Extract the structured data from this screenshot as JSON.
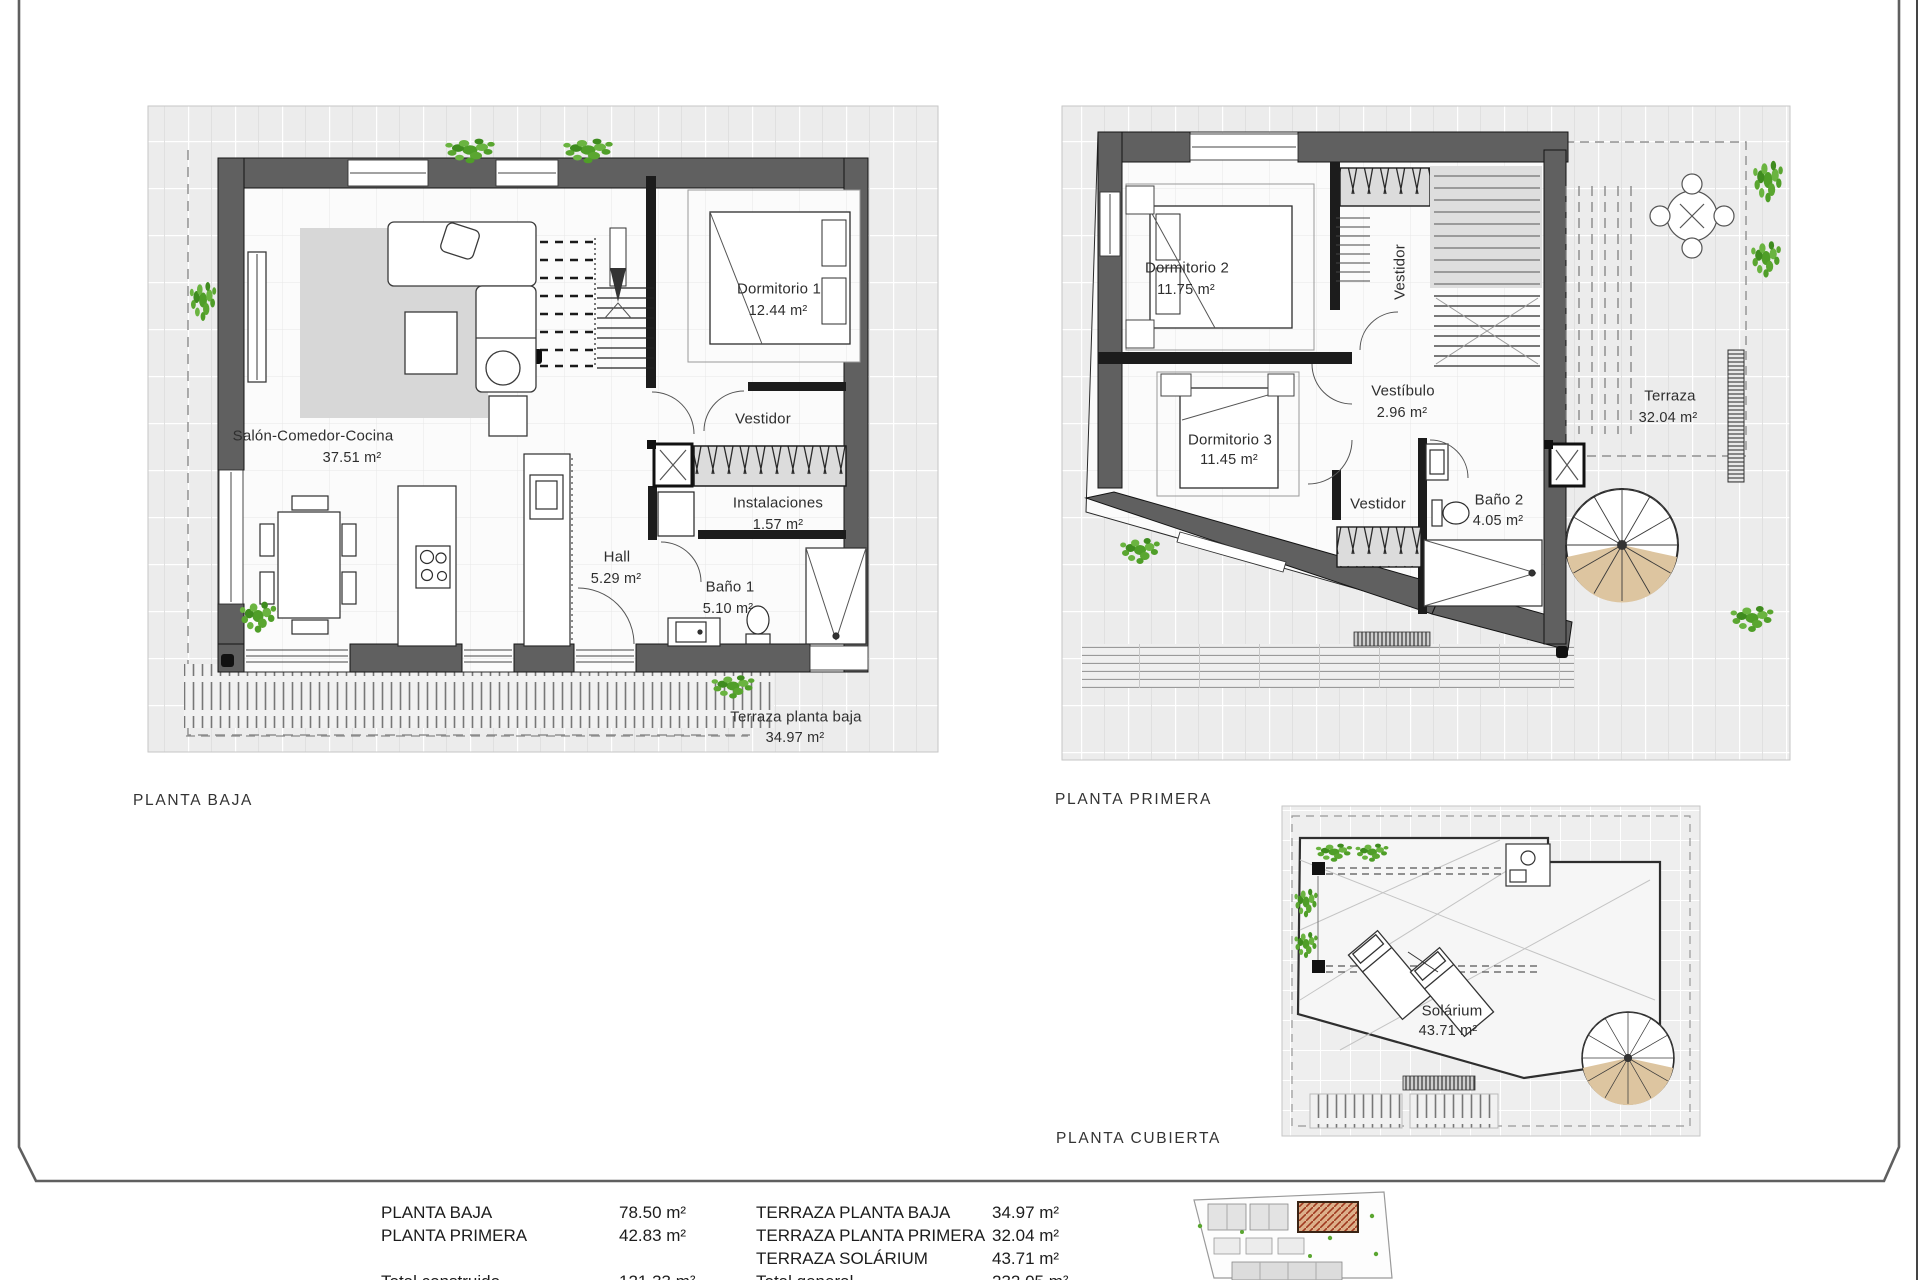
{
  "ground_floor": {
    "title": "PLANTA BAJA",
    "rooms": {
      "salon": {
        "name": "Salón-Comedor-Cocina",
        "area": "37.51 m²"
      },
      "dormitorio1": {
        "name": "Dormitorio 1",
        "area": "12.44 m²"
      },
      "vestidor": {
        "name": "Vestidor"
      },
      "instalaciones": {
        "name": "Instalaciones",
        "area": "1.57 m²"
      },
      "hall": {
        "name": "Hall",
        "area": "5.29 m²"
      },
      "bano1": {
        "name": "Baño 1",
        "area": "5.10 m²"
      },
      "terraza": {
        "name": "Terraza planta baja",
        "area": "34.97 m²"
      }
    }
  },
  "first_floor": {
    "title": "PLANTA PRIMERA",
    "rooms": {
      "dormitorio2": {
        "name": "Dormitorio 2",
        "area": "11.75 m²"
      },
      "dormitorio3": {
        "name": "Dormitorio 3",
        "area": "11.45 m²"
      },
      "vestibulo": {
        "name": "Vestíbulo",
        "area": "2.96 m²"
      },
      "vestidor_armario": {
        "name": "Vestidor"
      },
      "vestidor_pasillo": {
        "name": "Vestidor"
      },
      "bano2": {
        "name": "Baño 2",
        "area": "4.05 m²"
      },
      "terraza": {
        "name": "Terraza",
        "area": "32.04 m²"
      }
    }
  },
  "roof_floor": {
    "title": "PLANTA CUBIERTA",
    "rooms": {
      "solarium": {
        "name": "Solárium",
        "area": "43.71 m²"
      }
    }
  },
  "summary": {
    "left_rows": [
      {
        "label": "PLANTA BAJA",
        "value": "78.50 m²"
      },
      {
        "label": "PLANTA PRIMERA",
        "value": "42.83 m²"
      },
      {
        "label": "Total construido",
        "value": "121.33 m²"
      }
    ],
    "right_rows": [
      {
        "label": "TERRAZA PLANTA BAJA",
        "value": "34.97 m²"
      },
      {
        "label": "TERRAZA PLANTA PRIMERA",
        "value": "32.04 m²"
      },
      {
        "label": "TERRAZA SOLÁRIUM",
        "value": "43.71 m²"
      },
      {
        "label": "Total general",
        "value": "232.05 m²"
      }
    ]
  },
  "colors": {
    "wall_gray": "#606060",
    "plant_green": "#5aa630",
    "stair_wood": "#ddc5a0",
    "site_highlight": "#b34a2a"
  }
}
